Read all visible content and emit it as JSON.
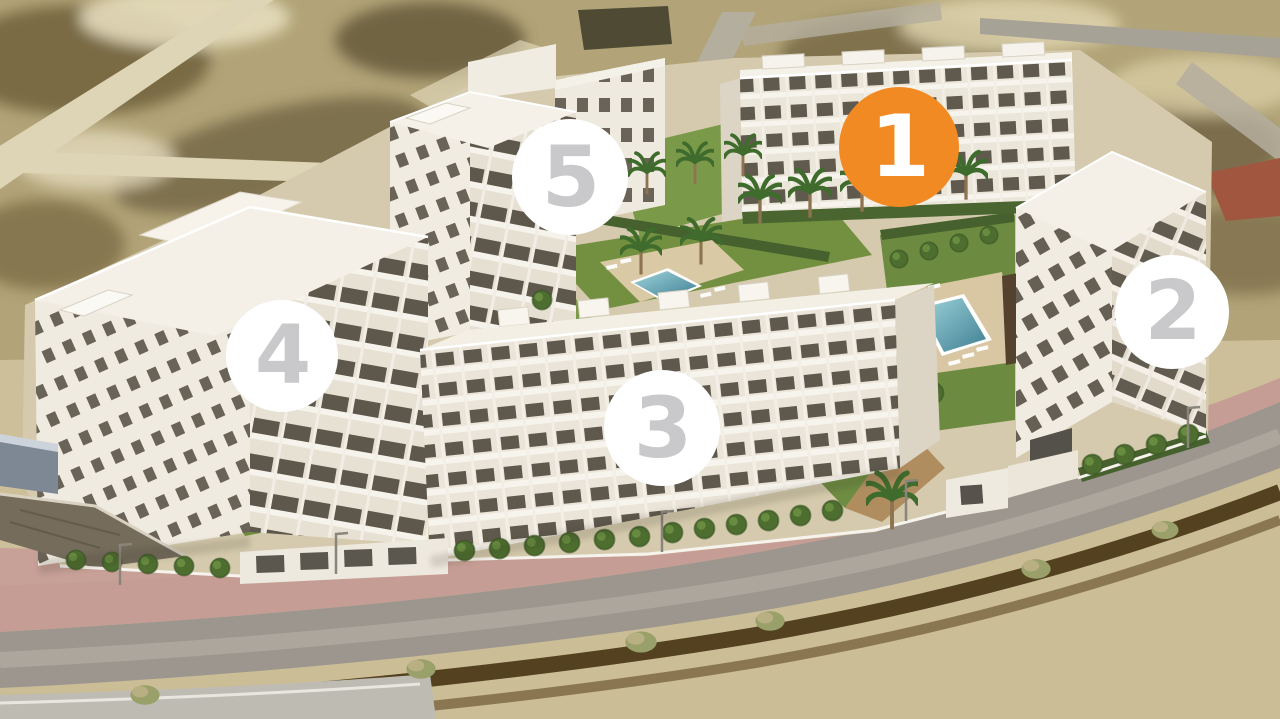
{
  "scene": {
    "width": 1280,
    "height": 719
  },
  "markers": [
    {
      "label": "1",
      "x": 899,
      "y": 147,
      "diameter": 120,
      "background": "#F18A23",
      "color": "#FFFFFF",
      "highlighted": true
    },
    {
      "label": "2",
      "x": 1172,
      "y": 312,
      "diameter": 114,
      "background": "#FFFFFF",
      "color": "#C9C9CB",
      "highlighted": false
    },
    {
      "label": "3",
      "x": 662,
      "y": 428,
      "diameter": 116,
      "background": "#FFFFFF",
      "color": "#C9C9CB",
      "highlighted": false
    },
    {
      "label": "4",
      "x": 282,
      "y": 356,
      "diameter": 112,
      "background": "#FFFFFF",
      "color": "#C9C9CB",
      "highlighted": false
    },
    {
      "label": "5",
      "x": 570,
      "y": 177,
      "diameter": 116,
      "background": "#FFFFFF",
      "color": "#C9C9CB",
      "highlighted": false
    }
  ],
  "palette": {
    "highlight_orange": "#F18A23",
    "marker_number_gray": "#C9C9CB",
    "sand_light": "#d8cdab",
    "scrub_dark": "#6a5c3a",
    "asphalt": "#9c968e",
    "sidewalk_pink": "#c59d94",
    "lawn_green": "#6e8c42",
    "hedge_green": "#47612e",
    "pool_blue": "#4f93a8",
    "building_white": "#efeadf",
    "dirt_furrow": "#54411f"
  }
}
